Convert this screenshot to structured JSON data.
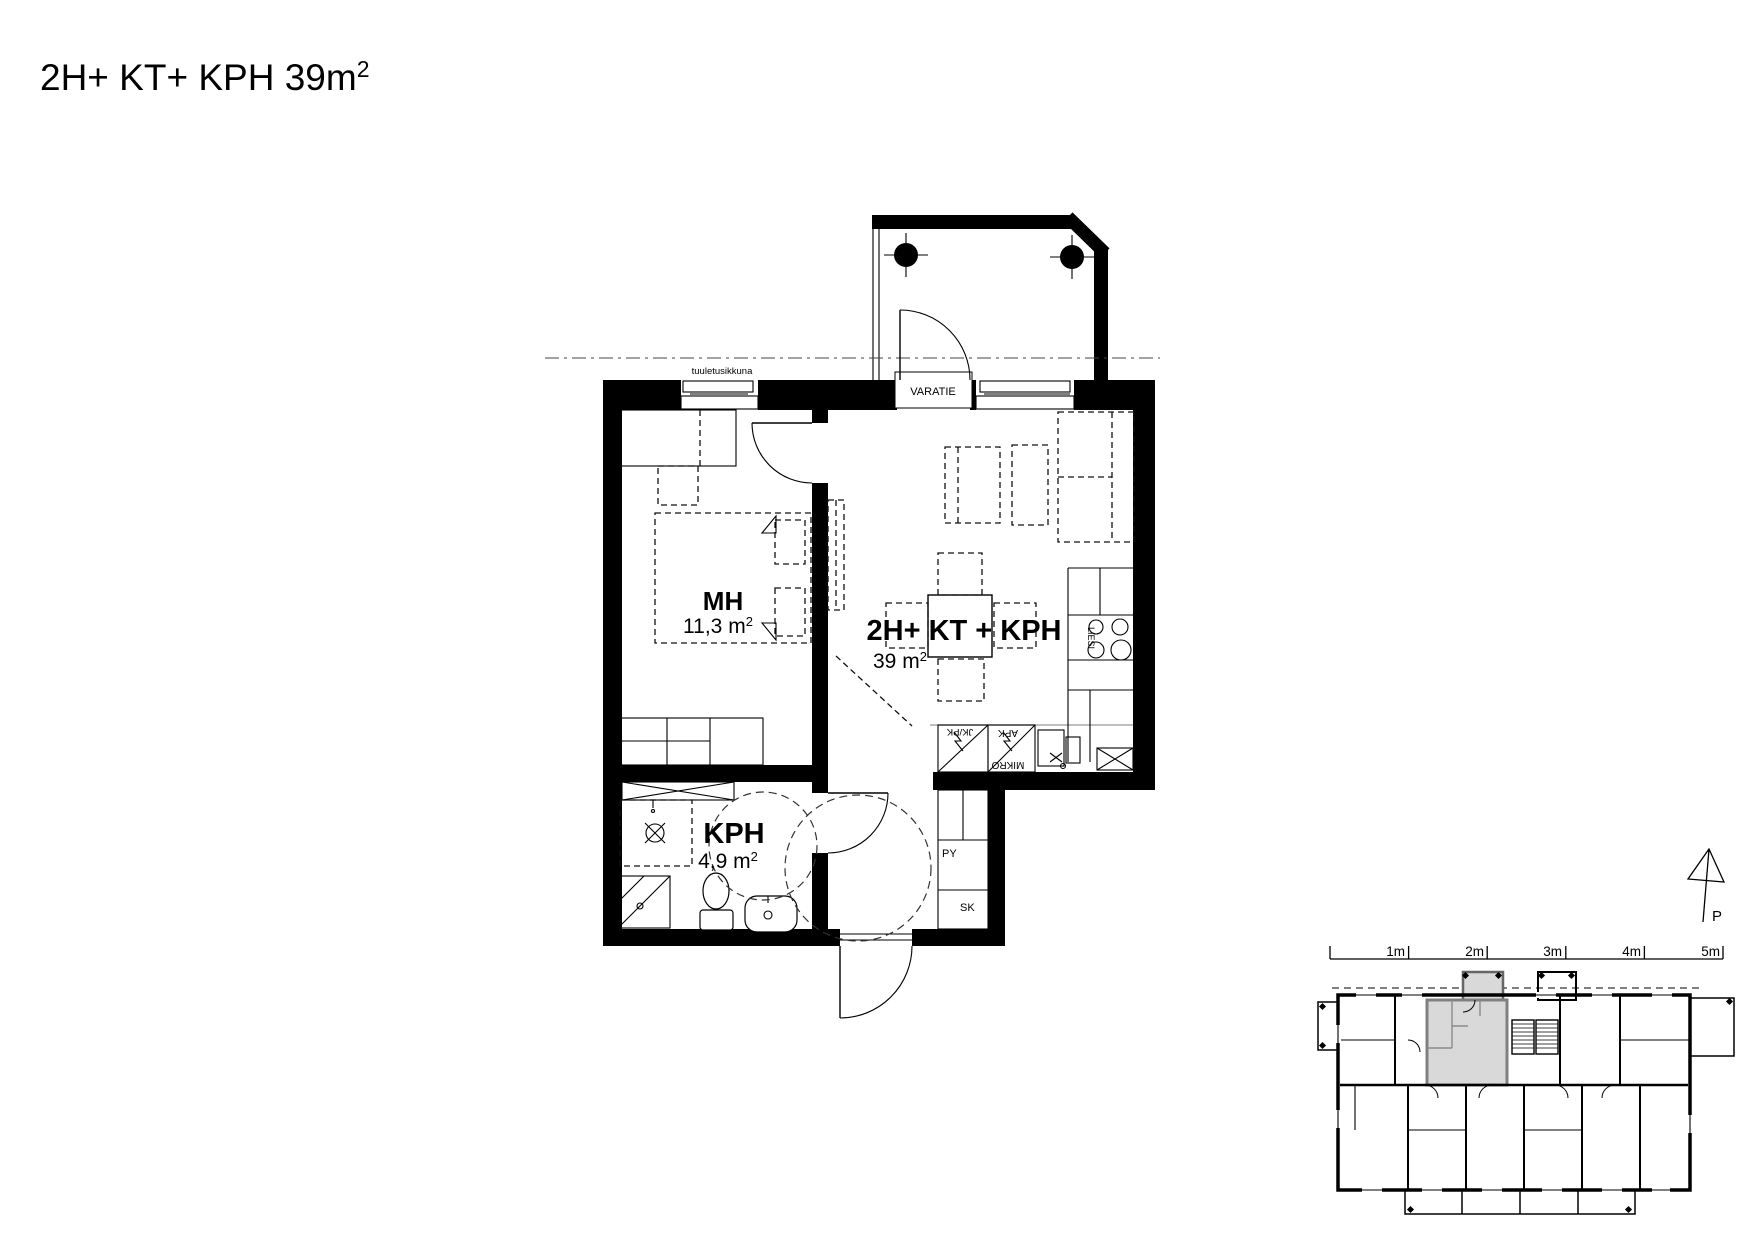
{
  "page": {
    "title": "2H+ KT+ KPH 39m",
    "title_sup": "2"
  },
  "floor_plan": {
    "rooms": {
      "bedroom": {
        "label": "MH",
        "area": "11,3 m",
        "area_sup": "2"
      },
      "living": {
        "label": "2H+ KT + KPH",
        "area": "39 m",
        "area_sup": "2"
      },
      "bathroom": {
        "label": "KPH",
        "area": "4,9 m",
        "area_sup": "2"
      }
    },
    "labels": {
      "vent_window": "tuuletusikkuna",
      "emergency_exit": "VARATIE",
      "stove": "LIESI",
      "fridge_freezer": "JK/PK",
      "dishwasher": "APK",
      "microwave": "MIKRO",
      "laundry_closet": "PY",
      "cleaning_closet": "SK"
    }
  },
  "site_plan": {
    "north_label": "P",
    "scale_labels": [
      "1m",
      "2m",
      "3m",
      "4m",
      "5m"
    ]
  }
}
